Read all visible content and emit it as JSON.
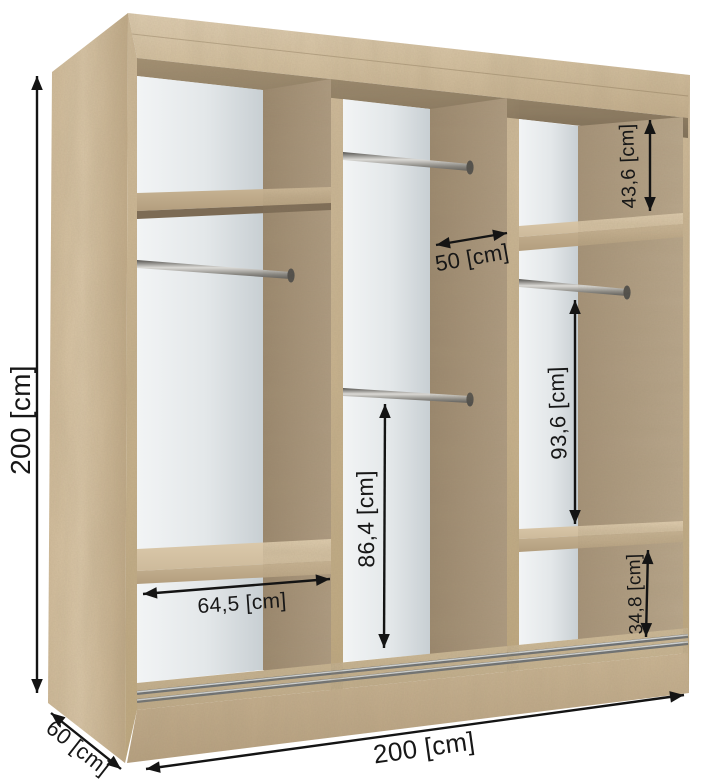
{
  "diagram": {
    "type": "wardrobe-interior-dimensions",
    "unit_format": "[cm]",
    "dimensions": {
      "overall_height": "200 [cm]",
      "overall_width": "200 [cm]",
      "overall_depth": "60 [cm]",
      "middle_section_width": "50 [cm]",
      "left_section_shelf_width": "64,5 [cm]",
      "middle_section_lower_height": "86,4 [cm]",
      "right_section_top_height": "43,6 [cm]",
      "right_section_middle_height": "93,6 [cm]",
      "right_section_bottom_height": "34,8 [cm]"
    },
    "colors": {
      "background": "#ffffff",
      "wood_light": "#d5c2a4",
      "wood_medium": "#c4b08f",
      "wood_shadow": "#9c8a72",
      "back_panel_white": "#e8ebec",
      "metal_rod": "#a8a8a6",
      "annotation": "#161616"
    }
  }
}
